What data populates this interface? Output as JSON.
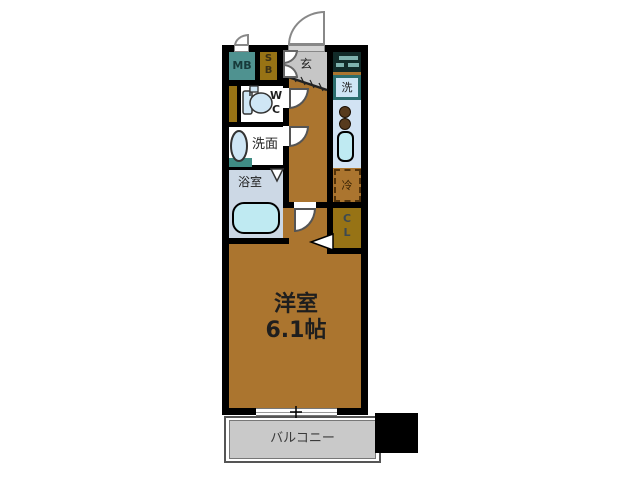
{
  "title": "apartment-floor-plan",
  "palette": {
    "wall": "#000000",
    "floor": "#ab752f",
    "teal": "#4f9290",
    "teal_strip": "#3f8c84",
    "goldenrod": "#977315",
    "genkan_gray": "#c6c6c6",
    "cabinet_dark": "#122b29",
    "cabinet_bar": "#7fb2ae",
    "frame_teal": "#2c6e6e",
    "fixture_blue": "#cfe6f5",
    "tub_blue": "#bfeaf2",
    "kitchen_blue": "#d2e3f3",
    "bath_gray": "#ccd8e5",
    "balcony_gray": "#c9c9c9",
    "dash_brown": "#53330a",
    "burner_brown": "#573a1d",
    "arc_stroke": "#888888",
    "text_dark": "#1e1e1e"
  },
  "rooms": {
    "meter_box": {
      "label": "MB"
    },
    "shoe_box": {
      "letters": [
        "S",
        "B"
      ]
    },
    "entrance": {
      "label": "玄"
    },
    "washer": {
      "label": "洗"
    },
    "wc": {
      "letters": [
        "W",
        "C"
      ]
    },
    "washroom": {
      "label": "洗面"
    },
    "bathroom": {
      "label": "浴室"
    },
    "fridge": {
      "label": "冷"
    },
    "closet": {
      "letters": [
        "C",
        "L"
      ]
    },
    "main_room": {
      "name": "洋室",
      "size": "6.1帖"
    },
    "balcony": {
      "label": "バルコニー"
    }
  },
  "icons": {
    "toilet": "toilet-icon",
    "vanity_sink": "sink-oval-icon",
    "bathtub": "bathtub-icon",
    "stove": "stove-burners-icon",
    "kitchen_sink": "kitchen-sink-icon",
    "shoe_cabinet": "shoe-cabinet-icon",
    "door_swing": "door-swing-arc-icon",
    "folding_door": "folding-door-v-icon",
    "closet_door": "door-swing-triangle-icon",
    "window": "sliding-window-icon"
  }
}
